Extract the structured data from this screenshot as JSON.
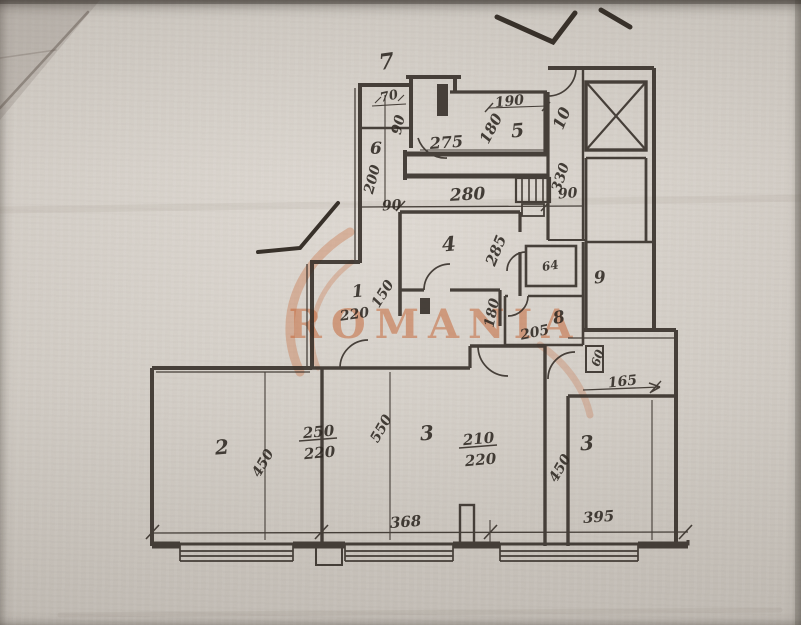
{
  "colors": {
    "paper": "#d3ccc3",
    "ink": "#2e2822",
    "watermark_orange": "#c4602f"
  },
  "watermark": {
    "text": "ROMANIA"
  },
  "plan": {
    "room_numbers": [
      "1",
      "2",
      "3",
      "3",
      "4",
      "5",
      "6",
      "7",
      "8",
      "9",
      "10"
    ],
    "texts": [
      {
        "id": "room7",
        "text": "7"
      },
      {
        "id": "dim70",
        "text": "70"
      },
      {
        "id": "dim90-left",
        "text": "90"
      },
      {
        "id": "room6",
        "text": "6"
      },
      {
        "id": "dim200",
        "text": "200"
      },
      {
        "id": "dim90-bottomleft",
        "text": "90"
      },
      {
        "id": "dim275",
        "text": "275"
      },
      {
        "id": "dim280",
        "text": "280"
      },
      {
        "id": "dim190",
        "text": "190"
      },
      {
        "id": "dim180-room5",
        "text": "180"
      },
      {
        "id": "room5",
        "text": "5"
      },
      {
        "id": "room10",
        "text": "10"
      },
      {
        "id": "dim330",
        "text": "330"
      },
      {
        "id": "dim90-right",
        "text": "90"
      },
      {
        "id": "room4",
        "text": "4"
      },
      {
        "id": "dim285",
        "text": "285"
      },
      {
        "id": "dim150",
        "text": "150"
      },
      {
        "id": "room1",
        "text": "1"
      },
      {
        "id": "dim220-hall",
        "text": "220"
      },
      {
        "id": "dim180-mid",
        "text": "180"
      },
      {
        "id": "wc64",
        "text": "64"
      },
      {
        "id": "room8",
        "text": "8"
      },
      {
        "id": "dim205",
        "text": "205"
      },
      {
        "id": "room9",
        "text": "9"
      },
      {
        "id": "dim60",
        "text": "60"
      },
      {
        "id": "dim165",
        "text": "165"
      },
      {
        "id": "room2",
        "text": "2"
      },
      {
        "id": "dim450-left",
        "text": "450"
      },
      {
        "id": "frac250",
        "text": "250"
      },
      {
        "id": "frac220-left",
        "text": "220"
      },
      {
        "id": "dim550",
        "text": "550"
      },
      {
        "id": "room3-mid",
        "text": "3"
      },
      {
        "id": "frac210",
        "text": "210"
      },
      {
        "id": "frac220-mid",
        "text": "220"
      },
      {
        "id": "dim368",
        "text": "368"
      },
      {
        "id": "dim450-right",
        "text": "450"
      },
      {
        "id": "room3-right",
        "text": "3"
      },
      {
        "id": "dim395",
        "text": "395"
      }
    ]
  }
}
